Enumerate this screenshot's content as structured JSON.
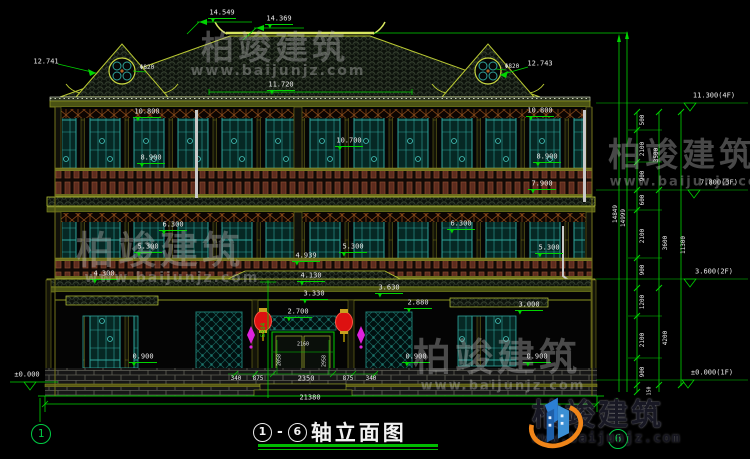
{
  "title_block": {
    "axis_start": "1",
    "axis_end": "6",
    "separator": "-",
    "title": "轴立面图"
  },
  "axis_bubbles": [
    {
      "label": "1"
    },
    {
      "label": "6"
    }
  ],
  "logo": {
    "name_cn": "柏竣建筑",
    "url": "www.baijunjz.com"
  },
  "colors": {
    "dim_line": "#00d400",
    "dim_text": "#e9e9e9",
    "roof_edge": "#b9c832",
    "lattice": "#2fa39a",
    "railing": "#5d2c1e",
    "lantern": "#dd1111",
    "ornament": "#dd22dd",
    "logo_blue": "#1e73be",
    "logo_orange": "#f08519"
  },
  "watermarks": [
    {
      "t": "柏竣建筑",
      "x": 275,
      "y": 45,
      "size": 33
    },
    {
      "t": "www.baijunjz.com",
      "x": 278,
      "y": 71,
      "size": 14,
      "url": true
    },
    {
      "t": "柏竣建筑",
      "x": 160,
      "y": 247,
      "size": 38
    },
    {
      "t": "www.baijunjz.com",
      "x": 172,
      "y": 278,
      "size": 14,
      "url": true
    },
    {
      "t": "柏竣建筑",
      "x": 682,
      "y": 152,
      "size": 33
    },
    {
      "t": "www.baijunjz.com",
      "x": 692,
      "y": 182,
      "size": 13,
      "url": true
    },
    {
      "t": "柏竣建筑",
      "x": 497,
      "y": 354,
      "size": 38
    },
    {
      "t": "www.baijunjz.com",
      "x": 503,
      "y": 386,
      "size": 13,
      "url": true
    }
  ],
  "annotations": [
    {
      "t": "14.549",
      "x": 222,
      "y": 13,
      "mk": 1
    },
    {
      "t": "14.369",
      "x": 279,
      "y": 19,
      "mk": 1
    },
    {
      "t": "11.720",
      "x": 281,
      "y": 85,
      "mk": 1
    },
    {
      "t": "12.741",
      "x": 46,
      "y": 62
    },
    {
      "t": "Φ820",
      "x": 147,
      "y": 68,
      "size": 6
    },
    {
      "t": "Φ820",
      "x": 512,
      "y": 67,
      "size": 6
    },
    {
      "t": "12.743",
      "x": 540,
      "y": 64
    },
    {
      "t": "10.800",
      "x": 147,
      "y": 112,
      "mk": 1
    },
    {
      "t": "10.800",
      "x": 540,
      "y": 111,
      "mk": 1
    },
    {
      "t": "10.700",
      "x": 349,
      "y": 141,
      "mk": 1
    },
    {
      "t": "8.900",
      "x": 151,
      "y": 158,
      "mk": 1
    },
    {
      "t": "8.900",
      "x": 547,
      "y": 157,
      "mk": 1
    },
    {
      "t": "7.900",
      "x": 542,
      "y": 184,
      "mk": 1
    },
    {
      "t": "6.300",
      "x": 173,
      "y": 225,
      "mk": 1
    },
    {
      "t": "6.300",
      "x": 461,
      "y": 224,
      "mk": 1
    },
    {
      "t": "5.300",
      "x": 148,
      "y": 247,
      "mk": 1
    },
    {
      "t": "5.300",
      "x": 353,
      "y": 247,
      "mk": 1
    },
    {
      "t": "5.300",
      "x": 549,
      "y": 248,
      "mk": 1
    },
    {
      "t": "4.300",
      "x": 104,
      "y": 274,
      "mk": 1
    },
    {
      "t": "4.939",
      "x": 306,
      "y": 256,
      "mk": 1
    },
    {
      "t": "4.130",
      "x": 311,
      "y": 276,
      "mk": 1
    },
    {
      "t": "3.630",
      "x": 389,
      "y": 288,
      "mk": 1
    },
    {
      "t": "3.330",
      "x": 314,
      "y": 294,
      "mk": 1
    },
    {
      "t": "2.880",
      "x": 418,
      "y": 303,
      "mk": 1
    },
    {
      "t": "3.000",
      "x": 529,
      "y": 305,
      "mk": 1
    },
    {
      "t": "2.700",
      "x": 298,
      "y": 312,
      "mk": 1
    },
    {
      "t": "0.900",
      "x": 143,
      "y": 357,
      "mk": 1
    },
    {
      "t": "0.900",
      "x": 416,
      "y": 357,
      "mk": 1
    },
    {
      "t": "0.900",
      "x": 537,
      "y": 357,
      "mk": 1
    },
    {
      "t": "±0.000",
      "x": 27,
      "y": 375
    },
    {
      "t": "5384",
      "x": 264,
      "y": 330,
      "rot": -90,
      "color": "#00d400",
      "size": 6
    },
    {
      "t": "2160",
      "x": 303,
      "y": 345,
      "size": 5
    },
    {
      "t": "2058",
      "x": 280,
      "y": 360,
      "rot": -90,
      "size": 5
    },
    {
      "t": "2958",
      "x": 325,
      "y": 361,
      "rot": -90,
      "size": 5
    },
    {
      "t": "2350",
      "x": 306,
      "y": 379
    },
    {
      "t": "340",
      "x": 236,
      "y": 379,
      "size": 6
    },
    {
      "t": "875",
      "x": 258,
      "y": 379,
      "size": 6
    },
    {
      "t": "875",
      "x": 348,
      "y": 379,
      "size": 6
    },
    {
      "t": "340",
      "x": 371,
      "y": 379,
      "size": 6
    },
    {
      "t": "21380",
      "x": 310,
      "y": 398,
      "name": "overall-width-dim"
    },
    {
      "t": "500",
      "x": 643,
      "y": 120,
      "rot": -90,
      "size": 6
    },
    {
      "t": "2100",
      "x": 643,
      "y": 149,
      "rot": -90,
      "size": 6
    },
    {
      "t": "900",
      "x": 643,
      "y": 176,
      "rot": -90,
      "size": 6
    },
    {
      "t": "600",
      "x": 643,
      "y": 200,
      "rot": -90,
      "size": 6
    },
    {
      "t": "2100",
      "x": 643,
      "y": 236,
      "rot": -90,
      "size": 6
    },
    {
      "t": "900",
      "x": 643,
      "y": 270,
      "rot": -90,
      "size": 6
    },
    {
      "t": "1200",
      "x": 643,
      "y": 302,
      "rot": -90,
      "size": 6
    },
    {
      "t": "2100",
      "x": 643,
      "y": 340,
      "rot": -90,
      "size": 6
    },
    {
      "t": "900",
      "x": 643,
      "y": 372,
      "rot": -90,
      "size": 6
    },
    {
      "t": "150",
      "x": 650,
      "y": 391,
      "rot": -90,
      "size": 5
    },
    {
      "t": "3500",
      "x": 657,
      "y": 155,
      "rot": -90,
      "size": 6
    },
    {
      "t": "3600",
      "x": 666,
      "y": 243,
      "rot": -90,
      "size": 6
    },
    {
      "t": "4200",
      "x": 666,
      "y": 338,
      "rot": -90,
      "size": 6
    },
    {
      "t": "11300",
      "x": 684,
      "y": 245,
      "rot": -90,
      "size": 6
    },
    {
      "t": "14849",
      "x": 616,
      "y": 214,
      "rot": -90,
      "size": 6
    },
    {
      "t": "14999",
      "x": 624,
      "y": 218,
      "rot": -90,
      "size": 6
    },
    {
      "t": "11.300(4F)",
      "x": 714,
      "y": 96,
      "name": "level-4f"
    },
    {
      "t": "7.800(3F)",
      "x": 719,
      "y": 183,
      "name": "level-3f"
    },
    {
      "t": "3.600(2F)",
      "x": 714,
      "y": 272,
      "name": "level-2f"
    },
    {
      "t": "±0.000(1F)",
      "x": 712,
      "y": 373,
      "name": "level-1f"
    }
  ]
}
